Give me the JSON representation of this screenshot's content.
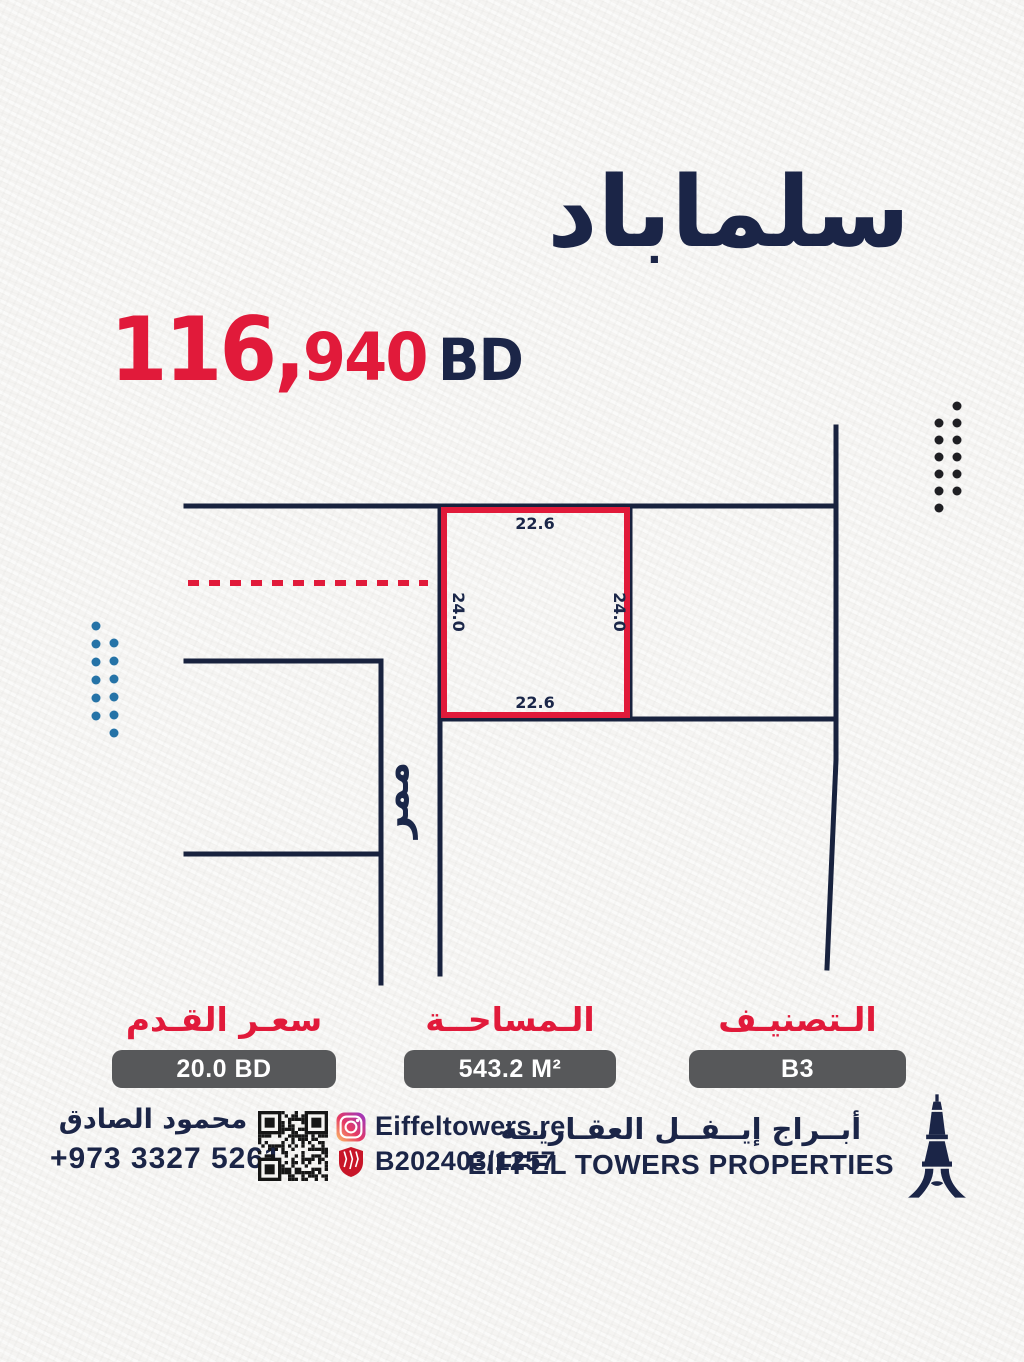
{
  "poster": {
    "title": "سلماباد",
    "price": {
      "main": "116,",
      "sub": "940",
      "currency": "BD"
    }
  },
  "map": {
    "plot": {
      "top": "22.6",
      "bottom": "22.6",
      "left": "24.0",
      "right": "24.0"
    },
    "street_label": "ممر"
  },
  "stats": {
    "classification": {
      "label": "الـتصنيـف",
      "value": "B3"
    },
    "area": {
      "label": "الـمساحــة",
      "value": "543.2 M²"
    },
    "price_per_foot": {
      "label": "سعـر القـدم",
      "value": "20.0 BD"
    }
  },
  "footer": {
    "agent_name": "محمود الصادق",
    "phone": "+973 3327 5261",
    "instagram_handle": "Eiffeltowers.re",
    "license_number": "B202403/1257",
    "company_name_ar": "أبــراج إيــفــل العقـاريــة",
    "company_name_en": "EIFFEL TOWERS PROPERTIES"
  },
  "colors": {
    "navy_text": "#1b2547",
    "navy_line": "#18223e",
    "red_accent": "#e11a3a",
    "blue_dots": "#2573a7",
    "dark_dots": "#1f1f23",
    "gray_box": "#57585a",
    "qr_dark": "#161616",
    "shield_red": "#c81528"
  }
}
